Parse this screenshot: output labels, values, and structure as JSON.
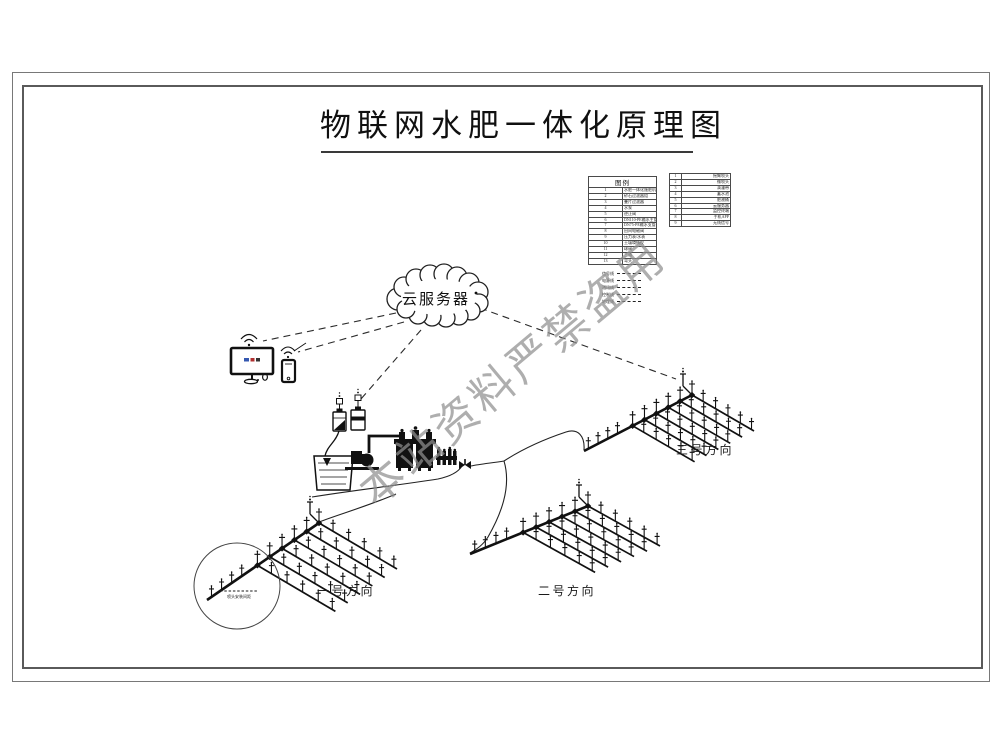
{
  "title": "物联网水肥一体化原理图",
  "watermark": "本站资料严禁盗用",
  "cloud": {
    "label": "云服务器"
  },
  "legend": {
    "left": {
      "header": "图例",
      "rows": [
        [
          "1",
          "水肥一体化施肥机"
        ],
        [
          "2",
          "砂石过滤器组"
        ],
        [
          "3",
          "叠片过滤器"
        ],
        [
          "4",
          "水泵"
        ],
        [
          "5",
          "逆止阀"
        ],
        [
          "6",
          "DN110-PE输水主管"
        ],
        [
          "7",
          "DN75-PE输水支管"
        ],
        [
          "8",
          "田间电磁阀"
        ],
        [
          "9",
          "压力表/水表"
        ],
        [
          "10",
          "土壤墒情仪"
        ],
        [
          "11",
          "球阀"
        ],
        [
          "12",
          "三通"
        ],
        [
          "13",
          "弯头"
        ]
      ]
    },
    "right": {
      "rows": [
        [
          "1",
          "摇臂喷头"
        ],
        [
          "2",
          "微喷头"
        ],
        [
          "3",
          "滴灌带"
        ],
        [
          "4",
          "蓄水池"
        ],
        [
          "5",
          "肥液桶"
        ],
        [
          "6",
          "云服务器"
        ],
        [
          "7",
          "监控终端"
        ],
        [
          "8",
          "手机APP"
        ],
        [
          "9",
          "无线信号"
        ]
      ]
    },
    "line_samples": [
      "信号线",
      "电源线",
      "通讯线",
      "控制线",
      "地埋线"
    ]
  },
  "fields": [
    {
      "label": "一号方向"
    },
    {
      "label": "二号方向"
    },
    {
      "label": "三号方向"
    }
  ],
  "callout": {
    "note": "喷头安装间距"
  },
  "colors": {
    "ink": "#141414",
    "watermark": "#8f8f8f",
    "screen_blue": "#3558b0",
    "screen_red": "#b03030"
  }
}
